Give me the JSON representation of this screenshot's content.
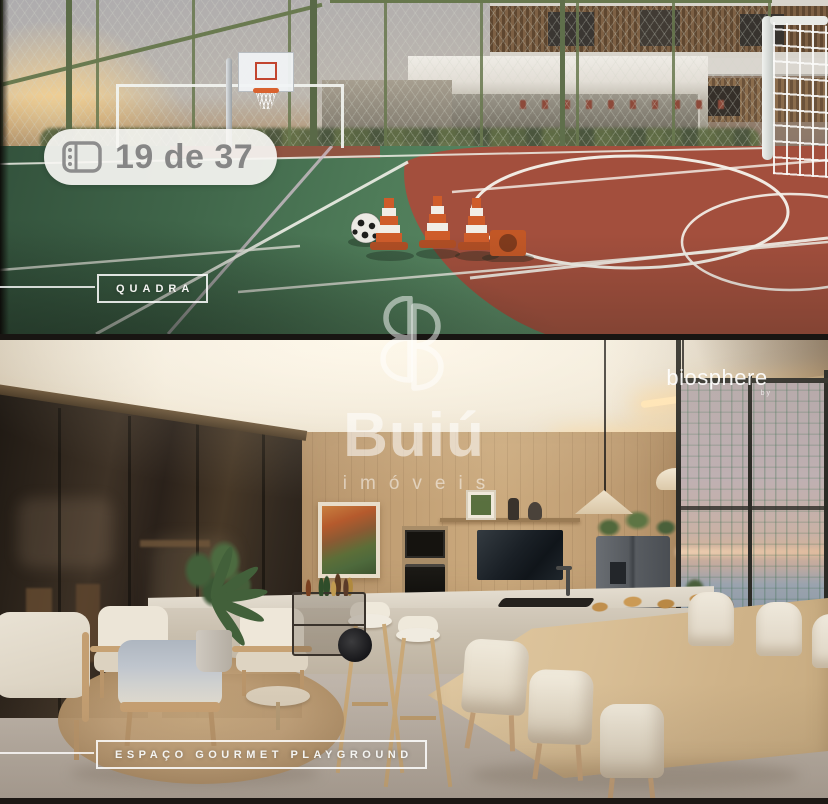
{
  "gallery_badge": {
    "icon": "photo-pages-icon",
    "label": "19 de 37"
  },
  "photos": [
    {
      "id": "quadra",
      "caption": "QUADRA"
    },
    {
      "id": "espaco-gourmet-playground",
      "caption": "ESPAÇO GOURMET PLAYGROUND"
    }
  ],
  "watermark": {
    "brand": "Buiú",
    "division": "imóveis",
    "monogram": "BB"
  },
  "development_brand": {
    "name": "biosphere",
    "tagline": "by"
  },
  "palette": {
    "badge_bg": "#f5f4f1",
    "badge_text": "#868686",
    "court_green": "#4f7c59",
    "court_clay": "#a34f3d",
    "fence_green": "#68784e",
    "wood_wall": "#c3a176",
    "caption_white": "#f4f4f2",
    "watermark_white": "rgba(255,255,255,0.55)"
  }
}
